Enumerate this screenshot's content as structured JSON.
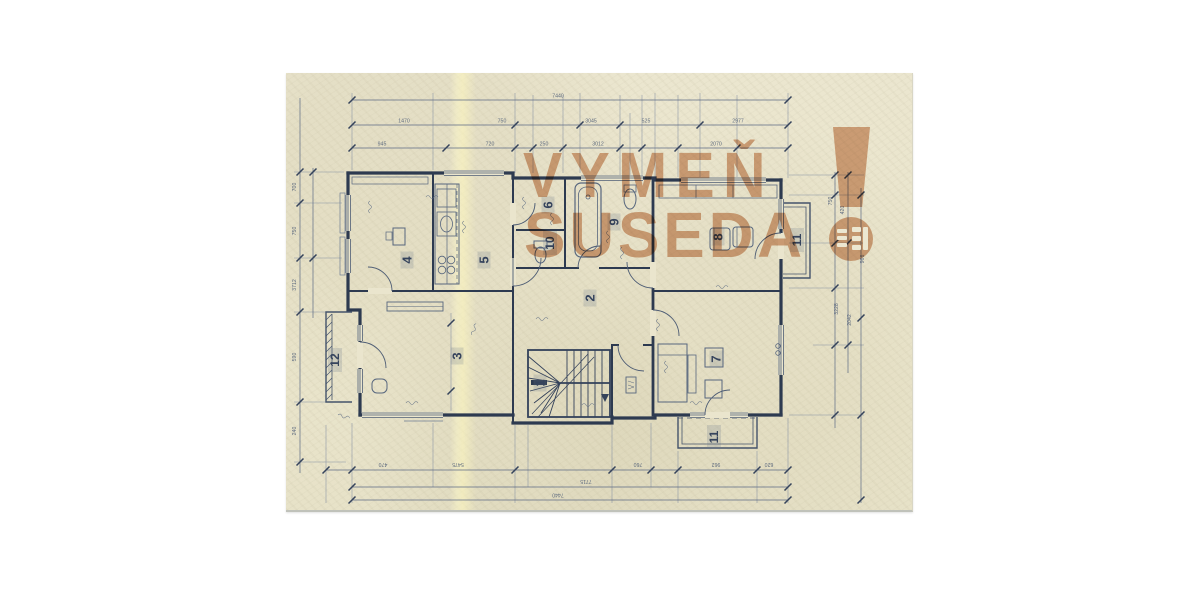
{
  "watermark": {
    "line1": "VYMEŇ",
    "line2": "SUSEDA",
    "exclamation": "!",
    "logo_icon": "vymen-suseda-window-logo",
    "color": "#d9a888"
  },
  "rooms": {
    "r1": {
      "label": "1"
    },
    "r2": {
      "label": "2"
    },
    "r3": {
      "label": "3"
    },
    "r4": {
      "label": "4"
    },
    "r5": {
      "label": "5"
    },
    "r6": {
      "label": "6"
    },
    "r7": {
      "label": "7"
    },
    "r8": {
      "label": "8"
    },
    "r9": {
      "label": "9"
    },
    "r10": {
      "label": "10"
    },
    "r11a": {
      "label": "11"
    },
    "r11b": {
      "label": "11"
    },
    "r12": {
      "label": "12"
    }
  },
  "dimensions": {
    "top": {
      "total": "7440",
      "row2": [
        "1470",
        "750",
        "3045",
        "525",
        "2977"
      ],
      "row3": [
        "945",
        "720",
        "250",
        "3012",
        "2070"
      ]
    },
    "bottom": {
      "row1": [
        "470",
        "5475",
        "760",
        "962",
        "620"
      ],
      "row2": "7715",
      "total": "7440"
    },
    "left": [
      "700",
      "750",
      "3712",
      "590",
      "240"
    ],
    "right": [
      "750",
      "420",
      "3228",
      "2042",
      "966"
    ]
  }
}
